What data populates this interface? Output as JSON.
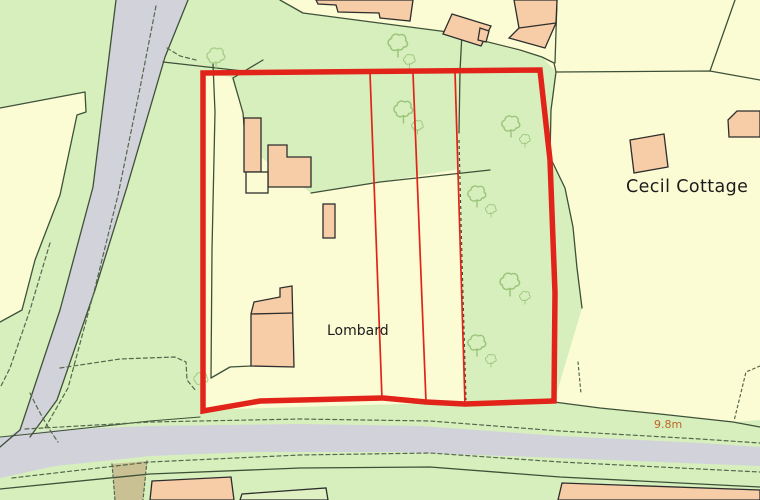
{
  "map": {
    "labels": {
      "property_name": "Lombard",
      "neighbor_property_name": "Cecil Cottage",
      "road_width_annotation": "9.8m"
    },
    "site_boundary": {
      "color": "#e2231a",
      "style": "thick red outline with three thin red internal plot division lines"
    },
    "colors": {
      "field_green": "#d6efbd",
      "parcel_yellow": "#fbfcd3",
      "road_grey": "#d2d2da",
      "building_peach": "#f6cda6",
      "building_outline": "#2d2d2d",
      "boundary_line": "#3e5138",
      "dashed_line": "#55684d",
      "tree_outline": "#9cc57c",
      "track_khaki": "#c9c193",
      "annotation_orange": "#c06426",
      "boundary_red": "#e2231a"
    },
    "features": [
      "diagonal road upper left",
      "horizontal road lower edge",
      "red site boundary around Lombard",
      "tree symbols",
      "buildings",
      "field parcels"
    ]
  }
}
